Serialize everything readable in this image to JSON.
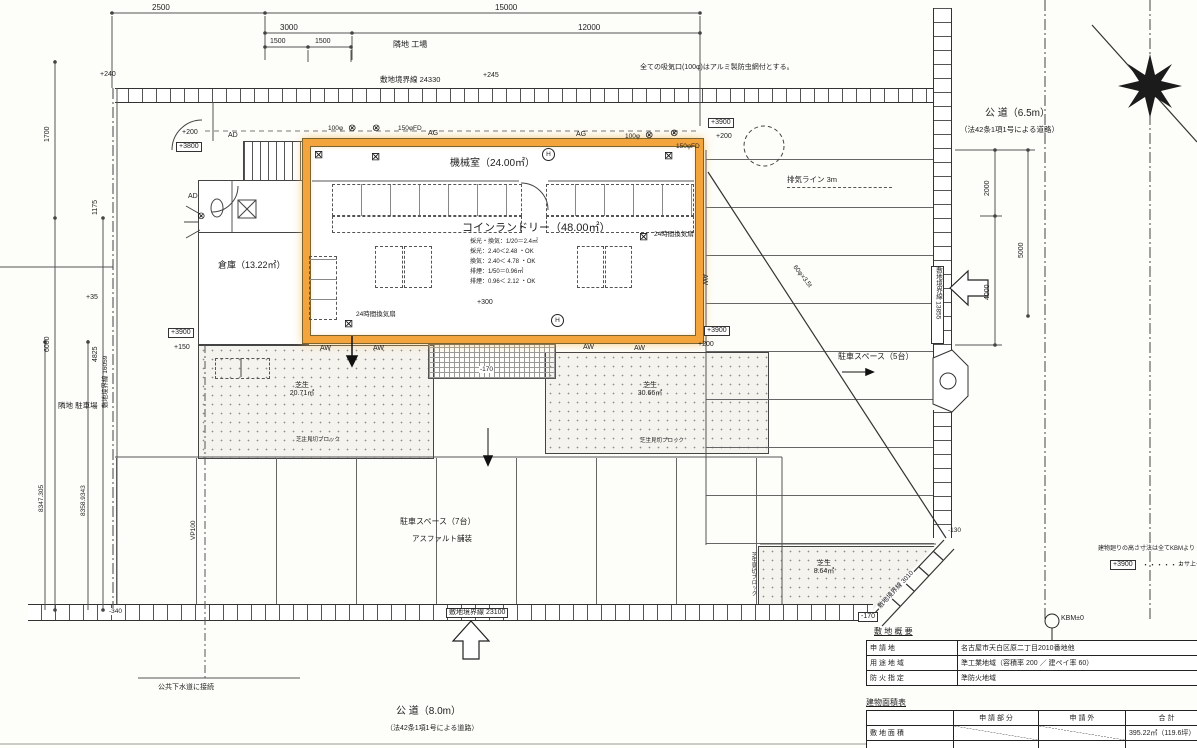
{
  "dims": {
    "top": [
      "2500",
      "15000",
      "3000",
      "12000",
      "1500",
      "1500"
    ],
    "left": [
      "1700",
      "1175",
      "6000",
      "4825",
      "8347.305",
      "8358.9343"
    ],
    "east": [
      "2000",
      "5000",
      "4000"
    ],
    "boundary_top": "敷地境界線 24330",
    "boundary_bottom": "敷地境界線 23100",
    "boundary_left": "敷地境界線 16059",
    "boundary_east": "敷地境界線 13855",
    "boundary_diag": "敷地境界線 3010"
  },
  "levels": {
    "p240": "+240",
    "p245": "+245",
    "p35": "+35",
    "p200": "+200",
    "p3800": "+3800",
    "p3900": "+3900",
    "p150": "+150",
    "p300": "+300",
    "m170": "-170",
    "m130": "-130",
    "m340": "-340",
    "kbm": "KBM±0"
  },
  "notes": {
    "intake": "全ての吸気口(100φ)はアルミ製防虫網付とする。",
    "neighbor_north": "隣地 工場",
    "neighbor_west": "隣地 駐車場",
    "exhaust_line": "排気ライン 3m",
    "sewer": "公共下水道に接続",
    "height_note": "建物廻りの高さ寸法は全てKBMより",
    "legend_dots": "・・・・・・",
    "legend_text": "カサ上ゲ",
    "pipe_v": "VP100",
    "pipe_diag": "60φ×3.5t"
  },
  "roads": {
    "east_name": "公 道（6.5m）",
    "east_law": "（法42条1項1号による道路）",
    "south_name": "公 道（8.0m）",
    "south_law": "（法42条1項1号による道路）"
  },
  "rooms": {
    "machine": "機械室（24.00㎡）",
    "laundry": "コインランドリー（48.00㎡）",
    "storage": "倉庫（13.22㎡）",
    "level": "+300"
  },
  "calc": [
    "採光・換気：1/20＝2.4㎡",
    "採光：2.40＜2.48 ・OK",
    "換気：2.40＜ 4.78 ・OK",
    "排煙：1/50＝0.96㎡",
    "排煙：0.96＜ 2.12 ・OK"
  ],
  "marks": {
    "ag": "AG",
    "aw": "AW",
    "ad": "AD",
    "h": "H",
    "vent100": "100φ",
    "vent150": "150φFD",
    "vent24": "24時間換気扇",
    "fan": "⊗",
    "boxfan": "⊠"
  },
  "lawn": {
    "name": "芝生",
    "left_area": "20.71㎡",
    "right_area": "30.66㎡",
    "se_area": "8.64㎡",
    "edge": "芝生見切ブロック"
  },
  "parking": {
    "south": "駐車スペース（7台）",
    "south_sub": "アスファルト舗装",
    "east": "駐車スペース（5台）"
  },
  "site_table": {
    "title": "敷 地 概 要",
    "rows": [
      [
        "申 請 地",
        "名古屋市天白区原二丁目2010番地他"
      ],
      [
        "用 途 地 域",
        "準工業地域（容積率 200 ／ 建ペイ率 60）"
      ],
      [
        "防 火 指 定",
        "準防火地域"
      ]
    ]
  },
  "area_table": {
    "title": "建物面積表",
    "headers": [
      "",
      "申 請 部 分",
      "申 請 外",
      "合 計"
    ],
    "rows": [
      [
        "敷 地 面 積",
        "",
        "",
        "395.22㎡（119.6坪）"
      ]
    ]
  }
}
